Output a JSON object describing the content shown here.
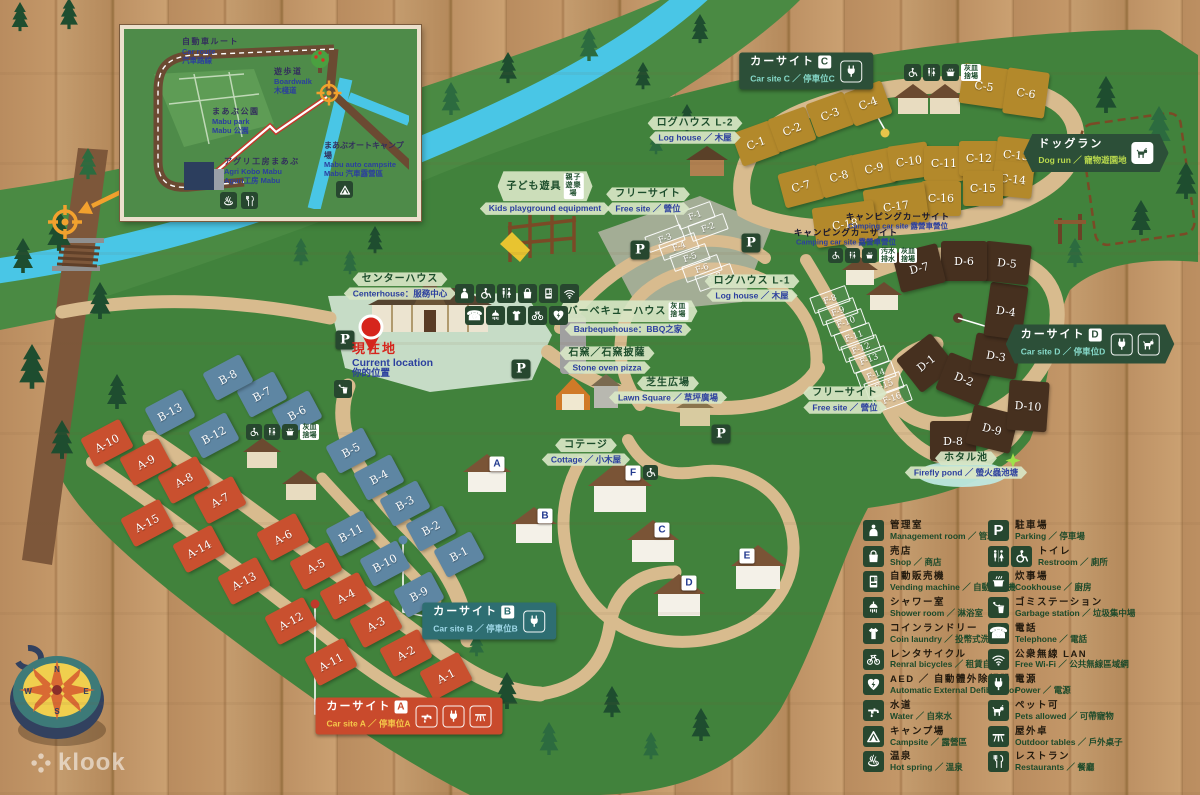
{
  "watermark": "klook",
  "compass": {
    "n": "N",
    "e": "E",
    "s": "S",
    "w": "W"
  },
  "current_location": {
    "ja": "現在地",
    "en": "Current location",
    "zh": "你的位置"
  },
  "inset": {
    "labels": {
      "car_route": {
        "ja": "自動車ルート",
        "en": "Car route",
        "zh": "汽車路線"
      },
      "boardwalk": {
        "ja": "遊歩道",
        "en": "Boardwalk",
        "zh": "木棧道"
      },
      "mabu_park": {
        "ja": "まあぶ公園",
        "en": "Mabu park",
        "zh": "Mabu 公園"
      },
      "agri_kobo": {
        "ja": "アグリ工房まあぶ",
        "en": "Agri Kobo Mabu",
        "zh": "Aguri工房 Mabu"
      },
      "campsite": {
        "ja": "まあぶオートキャンプ場",
        "en": "Mabu auto campsite",
        "zh": "Mabu 汽車露營區"
      }
    },
    "icons": [
      "campsite",
      "hot-spring",
      "restaurants"
    ]
  },
  "legend": {
    "columns": [
      {
        "items": [
          {
            "icons": [
              "management-room"
            ],
            "ja": "管理室",
            "en": "Management room",
            "zh": "管理室"
          },
          {
            "icons": [
              "shop"
            ],
            "ja": "売店",
            "en": "Shop",
            "zh": "商店"
          },
          {
            "icons": [
              "vending-machine"
            ],
            "ja": "自動販売機",
            "en": "Vending machine",
            "zh": "自動販賣機"
          },
          {
            "icons": [
              "shower-room"
            ],
            "ja": "シャワー室",
            "en": "Shower room",
            "zh": "淋浴室"
          },
          {
            "icons": [
              "coin-laundry"
            ],
            "ja": "コインランドリー",
            "en": "Coin laundry",
            "zh": "投幣式洗衣機"
          },
          {
            "icons": [
              "rental-bicycles"
            ],
            "ja": "レンタサイクル",
            "en": "Renral bicycles",
            "zh": "租賃自行車"
          },
          {
            "icons": [
              "aed"
            ],
            "ja": "AED ／ 自動體外除顫器",
            "en": "Automatic External Defibrillator",
            "zh": ""
          },
          {
            "icons": [
              "water"
            ],
            "ja": "水道",
            "en": "Water",
            "zh": "自來水"
          },
          {
            "icons": [
              "campsite"
            ],
            "ja": "キャンプ場",
            "en": "Campsite",
            "zh": "露營區"
          },
          {
            "icons": [
              "hot-spring"
            ],
            "ja": "温泉",
            "en": "Hot spring",
            "zh": "溫泉"
          }
        ]
      },
      {
        "items": [
          {
            "icons": [
              "parking"
            ],
            "ja": "駐車場",
            "en": "Parking",
            "zh": "停車場"
          },
          {
            "icons": [
              "restroom",
              "wheelchair"
            ],
            "ja": "トイレ",
            "en": "Restroom",
            "zh": "廁所"
          },
          {
            "icons": [
              "cookhouse"
            ],
            "ja": "炊事場",
            "en": "Cookhouse",
            "zh": "廚房"
          },
          {
            "icons": [
              "garbage-station"
            ],
            "ja": "ゴミステーション",
            "en": "Garbage station",
            "zh": "垃圾集中場"
          },
          {
            "icons": [
              "telephone"
            ],
            "ja": "電話",
            "en": "Telephone",
            "zh": "電話"
          },
          {
            "icons": [
              "free-wifi"
            ],
            "ja": "公衆無線 LAN",
            "en": "Free Wi-Fi",
            "zh": "公共無線區域網"
          },
          {
            "icons": [
              "power"
            ],
            "ja": "電源",
            "en": "Power",
            "zh": "電源"
          },
          {
            "icons": [
              "pets-allowed"
            ],
            "ja": "ペット可",
            "en": "Pets allowed",
            "zh": "可帶寵物"
          },
          {
            "icons": [
              "outdoor-tables"
            ],
            "ja": "屋外卓",
            "en": "Outdoor tables",
            "zh": "戶外桌子"
          },
          {
            "icons": [
              "restaurants"
            ],
            "ja": "レストラン",
            "en": "Restaurants",
            "zh": "餐廳"
          }
        ]
      }
    ]
  },
  "map": {
    "parking_glyph": "P",
    "parking_markers": [
      [
        345,
        340
      ],
      [
        521,
        369
      ],
      [
        640,
        250
      ],
      [
        751,
        243
      ],
      [
        721,
        434
      ]
    ],
    "site_groups": [
      {
        "name": "A",
        "color": "#c9502f",
        "style": "fill",
        "w": 44,
        "h": 32,
        "r": -28,
        "sites": [
          {
            "id": "A-1",
            "x": 446,
            "y": 676
          },
          {
            "id": "A-2",
            "x": 406,
            "y": 653
          },
          {
            "id": "A-3",
            "x": 376,
            "y": 624
          },
          {
            "id": "A-4",
            "x": 346,
            "y": 596
          },
          {
            "id": "A-5",
            "x": 316,
            "y": 566
          },
          {
            "id": "A-6",
            "x": 283,
            "y": 537
          },
          {
            "id": "A-7",
            "x": 220,
            "y": 500
          },
          {
            "id": "A-8",
            "x": 184,
            "y": 480
          },
          {
            "id": "A-9",
            "x": 146,
            "y": 462
          },
          {
            "id": "A-10",
            "x": 107,
            "y": 443
          },
          {
            "id": "A-11",
            "x": 331,
            "y": 662
          },
          {
            "id": "A-12",
            "x": 291,
            "y": 621
          },
          {
            "id": "A-13",
            "x": 244,
            "y": 581
          },
          {
            "id": "A-14",
            "x": 199,
            "y": 549
          },
          {
            "id": "A-15",
            "x": 147,
            "y": 523
          }
        ]
      },
      {
        "name": "B",
        "color": "#5e86a3",
        "style": "fill",
        "w": 42,
        "h": 31,
        "r": -28,
        "sites": [
          {
            "id": "B-1",
            "x": 459,
            "y": 554
          },
          {
            "id": "B-2",
            "x": 431,
            "y": 528
          },
          {
            "id": "B-3",
            "x": 405,
            "y": 503
          },
          {
            "id": "B-4",
            "x": 379,
            "y": 477
          },
          {
            "id": "B-5",
            "x": 351,
            "y": 450
          },
          {
            "id": "B-6",
            "x": 297,
            "y": 413
          },
          {
            "id": "B-7",
            "x": 262,
            "y": 394
          },
          {
            "id": "B-8",
            "x": 228,
            "y": 377
          },
          {
            "id": "B-9",
            "x": 419,
            "y": 594
          },
          {
            "id": "B-10",
            "x": 385,
            "y": 563
          },
          {
            "id": "B-11",
            "x": 351,
            "y": 533
          },
          {
            "id": "B-12",
            "x": 214,
            "y": 435
          },
          {
            "id": "B-13",
            "x": 170,
            "y": 412
          }
        ]
      },
      {
        "name": "C",
        "color": "#b3892b",
        "style": "fill",
        "w": 40,
        "h": 35,
        "r": 0,
        "sites": [
          {
            "id": "C-1",
            "x": 756,
            "y": 143,
            "r": -20
          },
          {
            "id": "C-2",
            "x": 792,
            "y": 129,
            "r": -20
          },
          {
            "id": "C-3",
            "x": 830,
            "y": 114,
            "r": -20
          },
          {
            "id": "C-4",
            "x": 868,
            "y": 103,
            "r": -20
          },
          {
            "id": "C-5",
            "x": 984,
            "y": 86,
            "r": 8,
            "w": 46,
            "h": 40
          },
          {
            "id": "C-6",
            "x": 1026,
            "y": 93,
            "r": 8,
            "w": 42,
            "h": 46
          },
          {
            "id": "C-7",
            "x": 801,
            "y": 186,
            "r": -15
          },
          {
            "id": "C-8",
            "x": 839,
            "y": 176,
            "r": -15
          },
          {
            "id": "C-9",
            "x": 874,
            "y": 168,
            "r": -12
          },
          {
            "id": "C-10",
            "x": 909,
            "y": 161,
            "r": -8
          },
          {
            "id": "C-11",
            "x": 944,
            "y": 163
          },
          {
            "id": "C-12",
            "x": 979,
            "y": 158
          },
          {
            "id": "C-13",
            "x": 1016,
            "y": 155,
            "r": 6
          },
          {
            "id": "C-14",
            "x": 1013,
            "y": 179,
            "r": 6
          },
          {
            "id": "C-15",
            "x": 983,
            "y": 188
          },
          {
            "id": "C-16",
            "x": 941,
            "y": 198
          },
          {
            "id": "C-17",
            "x": 896,
            "y": 206,
            "r": -8,
            "w": 62,
            "h": 40
          },
          {
            "id": "C-18",
            "x": 845,
            "y": 224,
            "r": -8,
            "w": 62,
            "h": 40
          }
        ]
      },
      {
        "name": "D",
        "color": "#46301f",
        "style": "fill",
        "w": 46,
        "h": 40,
        "r": 0,
        "sites": [
          {
            "id": "D-1",
            "x": 926,
            "y": 363,
            "r": -38,
            "w": 44,
            "h": 42
          },
          {
            "id": "D-2",
            "x": 964,
            "y": 379,
            "r": 22
          },
          {
            "id": "D-3",
            "x": 996,
            "y": 356,
            "r": 10
          },
          {
            "id": "D-4",
            "x": 1006,
            "y": 311,
            "r": 8,
            "w": 38,
            "h": 54
          },
          {
            "id": "D-5",
            "x": 1007,
            "y": 263,
            "r": 6
          },
          {
            "id": "D-6",
            "x": 964,
            "y": 261
          },
          {
            "id": "D-7",
            "x": 919,
            "y": 268,
            "r": -14
          },
          {
            "id": "D-8",
            "x": 953,
            "y": 441
          },
          {
            "id": "D-9",
            "x": 992,
            "y": 429,
            "r": 14
          },
          {
            "id": "D-10",
            "x": 1028,
            "y": 406,
            "r": 4,
            "w": 40,
            "h": 50
          }
        ]
      },
      {
        "name": "F",
        "color": "none",
        "style": "outline",
        "w": 36,
        "h": 15,
        "r": -20,
        "sites": [
          {
            "id": "F-1",
            "x": 694,
            "y": 214
          },
          {
            "id": "F-2",
            "x": 707,
            "y": 226
          },
          {
            "id": "F-3",
            "x": 664,
            "y": 237
          },
          {
            "id": "F-4",
            "x": 678,
            "y": 245
          },
          {
            "id": "F-5",
            "x": 689,
            "y": 256
          },
          {
            "id": "F-6",
            "x": 701,
            "y": 267
          },
          {
            "id": "F-7",
            "x": 714,
            "y": 276
          },
          {
            "id": "F-8",
            "x": 829,
            "y": 298
          },
          {
            "id": "F-9",
            "x": 837,
            "y": 310
          },
          {
            "id": "F-10",
            "x": 845,
            "y": 321
          },
          {
            "id": "F-11",
            "x": 853,
            "y": 335
          },
          {
            "id": "F-12",
            "x": 860,
            "y": 347
          },
          {
            "id": "F-13",
            "x": 868,
            "y": 358
          },
          {
            "id": "F-14",
            "x": 875,
            "y": 373
          },
          {
            "id": "F-15",
            "x": 883,
            "y": 384
          },
          {
            "id": "F-16",
            "x": 891,
            "y": 397
          }
        ]
      }
    ],
    "cottages": {
      "units": [
        {
          "id": "A",
          "x": 497,
          "y": 464
        },
        {
          "id": "B",
          "x": 545,
          "y": 516
        },
        {
          "id": "C",
          "x": 662,
          "y": 530
        },
        {
          "id": "D",
          "x": 689,
          "y": 583
        },
        {
          "id": "E",
          "x": 747,
          "y": 556
        },
        {
          "id": "F",
          "x": 633,
          "y": 473,
          "wc": true
        }
      ]
    },
    "badges": [
      {
        "x": 400,
        "y": 286,
        "ja": "センターハウス",
        "en": "Centerhouse：服務中心"
      },
      {
        "x": 545,
        "y": 193,
        "ja": "子ども遊具",
        "en": "Kids playground equipment",
        "tile": "親子遊樂場"
      },
      {
        "x": 648,
        "y": 201,
        "ja": "フリーサイト",
        "en": "Free site ／ 營位"
      },
      {
        "x": 695,
        "y": 130,
        "ja": "ログハウス L-2",
        "en": "Log house ／ 木屋"
      },
      {
        "x": 752,
        "y": 288,
        "ja": "ログハウス L-1",
        "en": "Log house ／ 木屋"
      },
      {
        "x": 628,
        "y": 318,
        "ja": "バーベキューハウス",
        "en": "Barbequehouse：BBQ之家",
        "tile": "灰皿捨場"
      },
      {
        "x": 607,
        "y": 360,
        "ja": "石窯／石窯披薩",
        "en": "Stone oven pizza"
      },
      {
        "x": 668,
        "y": 390,
        "ja": "芝生広場",
        "en": "Lawn Square ／ 草坪廣場"
      },
      {
        "x": 586,
        "y": 452,
        "ja": "コテージ",
        "en": "Cottage ／ 小木屋"
      },
      {
        "x": 845,
        "y": 400,
        "ja": "フリーサイト",
        "en": "Free site ／ 營位"
      },
      {
        "x": 966,
        "y": 465,
        "ja": "ホタル池",
        "en": "Firefly pond ／ 螢火蟲池塘"
      },
      {
        "x": 846,
        "y": 237,
        "plain": true,
        "ja": "キャンピングカーサイト",
        "en": "Camping car site 露營車營位"
      },
      {
        "x": 898,
        "y": 221,
        "plain": true,
        "ja": "キャンピングカーサイト",
        "en": "Camping car site 露營車營位"
      }
    ],
    "banners": [
      {
        "name": "car-site-c",
        "x": 806,
        "y": 71,
        "bg": "#2c4f38",
        "ja": "カーサイト",
        "letter": "C",
        "letterColor": "#2c4f38",
        "en": "Car site C ／ 停車位C",
        "enColor": "#86d9c9",
        "icons": [
          "power"
        ]
      },
      {
        "name": "car-site-d",
        "x": 1090,
        "y": 344,
        "bg": "#2c4f38",
        "ja": "カーサイト",
        "letter": "D",
        "letterColor": "#2c4f38",
        "en": "Car site D ／ 停車位D",
        "enColor": "#86d9c9",
        "icons": [
          "power",
          "pets-allowed"
        ],
        "arrow": true
      },
      {
        "name": "car-site-b",
        "x": 489,
        "y": 621,
        "bg": "#2e6e72",
        "ja": "カーサイト",
        "letter": "B",
        "letterColor": "#2e6e72",
        "en": "Car site B ／ 停車位B",
        "enColor": "#9fd8e8",
        "icons": [
          "power"
        ]
      },
      {
        "name": "car-site-a",
        "x": 409,
        "y": 716,
        "bg": "#c94a2c",
        "ja": "カーサイト",
        "letter": "A",
        "letterColor": "#c94a2c",
        "en": "Car site A ／ 停車位A",
        "enColor": "#f5c84a",
        "icons": [
          "water",
          "power",
          "outdoor-tables"
        ]
      },
      {
        "name": "dog-run",
        "x": 1096,
        "y": 153,
        "bg": "#2c4f38",
        "ja": "ドッグラン",
        "letter": "",
        "letterColor": "",
        "en": "Dog run ／ 寵物遊園地",
        "enColor": "#b9d94d",
        "icons": [
          "pets-allowed"
        ],
        "arrow": true,
        "solidTiles": true
      }
    ],
    "icon_clusters": [
      {
        "x": 455,
        "y": 284,
        "size": 19,
        "tiles": [
          {
            "i": "management-room"
          },
          {
            "i": "wheelchair"
          },
          {
            "i": "restroom"
          },
          {
            "i": "shop"
          },
          {
            "i": "vending-machine"
          },
          {
            "i": "free-wifi"
          }
        ]
      },
      {
        "x": 465,
        "y": 306,
        "size": 19,
        "tiles": [
          {
            "i": "telephone"
          },
          {
            "i": "shower-room"
          },
          {
            "i": "coin-laundry"
          },
          {
            "i": "rental-bicycles"
          },
          {
            "i": "aed"
          }
        ]
      },
      {
        "x": 246,
        "y": 424,
        "size": 16,
        "tiles": [
          {
            "i": "wheelchair"
          },
          {
            "i": "restroom"
          },
          {
            "i": "cookhouse"
          },
          {
            "t": "灰皿捨場"
          }
        ]
      },
      {
        "x": 904,
        "y": 64,
        "size": 17,
        "tiles": [
          {
            "i": "wheelchair"
          },
          {
            "i": "restroom"
          },
          {
            "i": "cookhouse"
          },
          {
            "t": "灰皿捨場"
          }
        ]
      },
      {
        "x": 828,
        "y": 248,
        "size": 15,
        "tiles": [
          {
            "i": "wheelchair"
          },
          {
            "i": "restroom"
          },
          {
            "i": "cookhouse"
          },
          {
            "t": "汚水排水"
          },
          {
            "t": "灰皿捨場"
          }
        ]
      },
      {
        "x": 334,
        "y": 380,
        "size": 18,
        "tiles": [
          {
            "i": "garbage-station"
          }
        ]
      }
    ]
  }
}
